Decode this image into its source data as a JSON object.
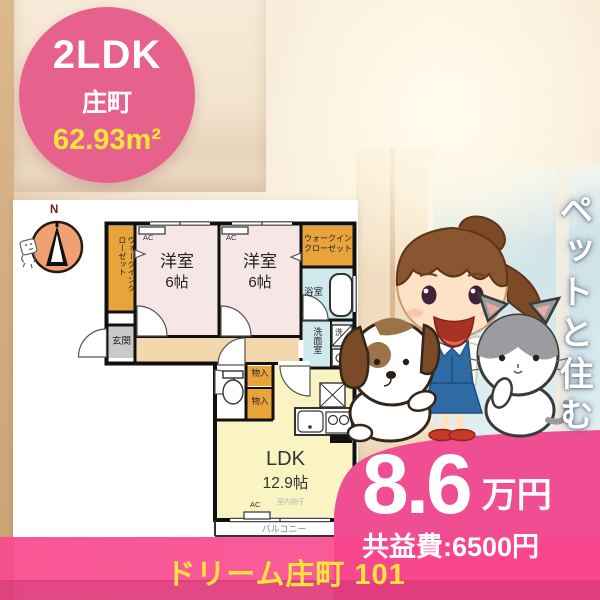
{
  "badge": {
    "layout": "2LDK",
    "district": "庄町",
    "area": "62.93m²"
  },
  "tagline": "ペットと住む",
  "price": {
    "rent": "8.6",
    "unit": "万円",
    "common_fee": "共益費:6500円"
  },
  "footer": {
    "property": "ドリーム庄町 101"
  },
  "floorplan": {
    "compass_n": "N",
    "labels": {
      "walkin_vertical": "ウォークインクローゼット",
      "walkin_line1": "ウォークイン",
      "walkin_line2": "クローゼット",
      "western_room": "洋室",
      "western_room_size": "6帖",
      "ac": "AC",
      "bath": "浴室",
      "washroom": "洗面室",
      "wash_symbol": "洗",
      "entrance": "玄関",
      "storage": "物入",
      "ldk": "LDK",
      "ldk_size": "12.9帖",
      "indoor_drying": "室内物干",
      "balcony": "バルコニー"
    }
  },
  "colors": {
    "badge_pink": "#e6618c",
    "blob_pink": "#ef4e93",
    "band_pink": "#f8458d",
    "band_dark_pink": "#e23c7e",
    "accent_yellow": "#f9e43a",
    "footer_yellow": "#ffe43c",
    "closet_orange": "#e8a33b",
    "room_pink": "#f6e6e6",
    "wet_area_blue": "#cfe9ed",
    "ldk_yellow": "#faf3c2",
    "corridor_tan": "#f3d8ad",
    "entrance_gray": "#c9c9c9",
    "compass_orange": "#f0a173"
  }
}
